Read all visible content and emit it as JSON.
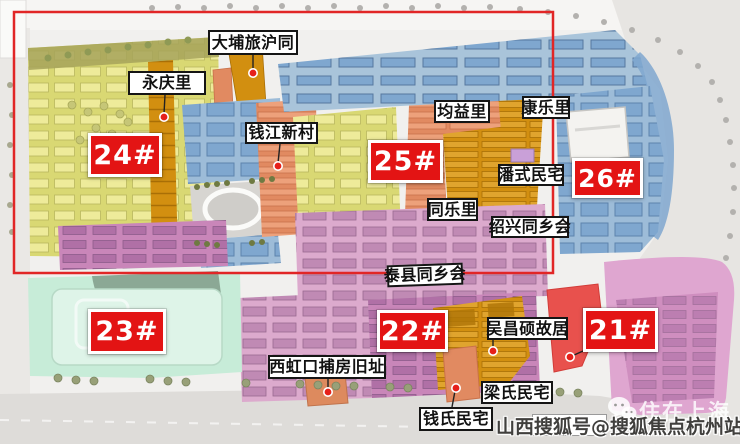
{
  "blocks": {
    "b21": "21#",
    "b22": "22#",
    "b23": "23#",
    "b24": "24#",
    "b25": "25#",
    "b26": "26#"
  },
  "area_labels": {
    "dapu_luhu_tong": "大埔旅沪同",
    "yongqingli": "永庆里",
    "qianjiang_xincun": "钱江新村",
    "junyili": "均益里",
    "kangleli": "康乐里",
    "panshi_minzhai": "潘式民宅",
    "tongleli": "同乐里",
    "shaoxing_tongxianghui": "绍兴同乡会",
    "taixian_tongxianghui": "泰县同乡会",
    "xihongkou_bufang_jiuzhi": "西虹口捕房旧址",
    "wuchangshuo_guju": "吴昌硕故居",
    "liangshi_minzhai": "梁氏民宅",
    "qianshi_minzhai": "钱氏民宅"
  },
  "watermark": {
    "account": "山西搜狐号@搜狐焦点杭州站",
    "brand": "住在上海"
  },
  "colors": {
    "badge_red": "#e31414",
    "highlight_rect_red": "#e12626",
    "marker_dot_red": "#e6201a",
    "block_yellow_green": "#d9d873",
    "block_amber": "#d28f10",
    "block_salmon": "#e18a61",
    "block_blue": "#7fa7cf",
    "block_pink_light": "#dcaacd",
    "block_magenta": "#c986b9",
    "block_mint": "#c7ecd8",
    "building_bright_red": "#e8514d",
    "road_gray": "#dedcd9"
  }
}
